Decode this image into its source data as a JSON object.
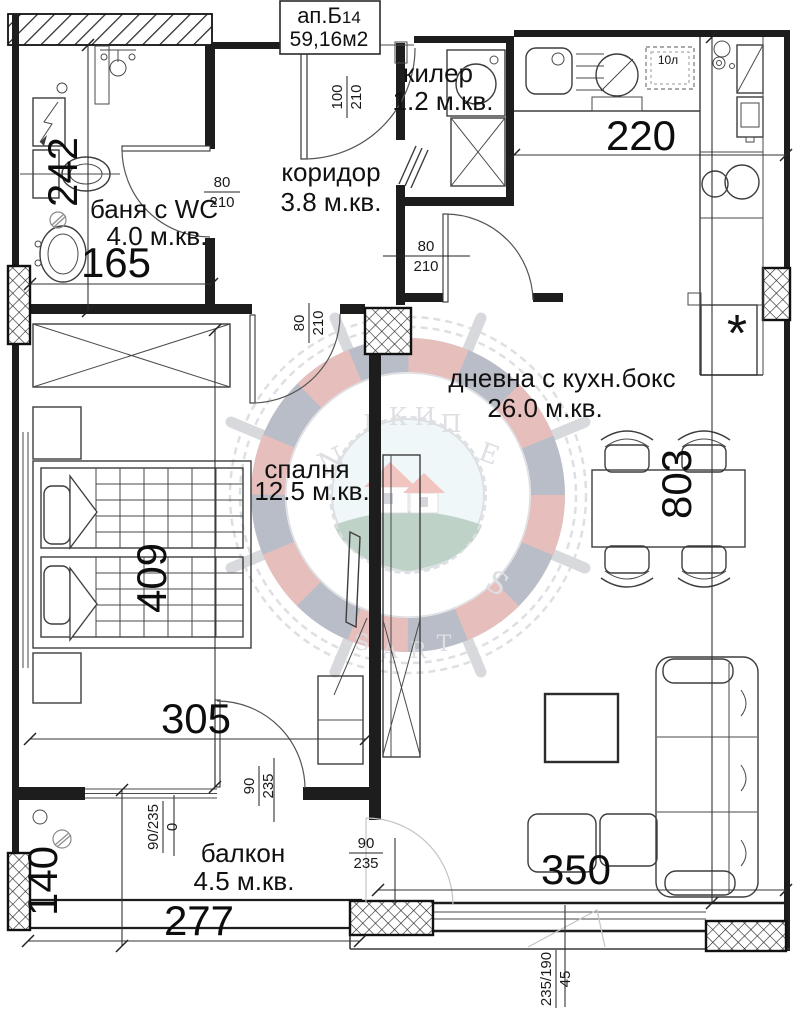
{
  "title": {
    "name": "ап.Б",
    "unit_number": "14",
    "total_area": "59,16м2"
  },
  "rooms": {
    "bathroom": {
      "name": "баня с WC",
      "area": "4.0 м.кв."
    },
    "corridor": {
      "name": "коридор",
      "area": "3.8 м.кв."
    },
    "closet": {
      "name": "килер",
      "area": "1.2 м.кв."
    },
    "living": {
      "name": "дневна с кухн.бокс",
      "area": "26.0 м.кв."
    },
    "bedroom": {
      "name": "спалня",
      "area": "12.5 м.кв."
    },
    "balcony": {
      "name": "балкон",
      "area": "4.5 м.кв."
    }
  },
  "dimensions": {
    "bathroom_depth": "242",
    "bathroom_width": "165",
    "kitchen_wall": "220",
    "living_depth": "803",
    "living_width": "350",
    "bedroom_depth": "409",
    "bedroom_width": "305",
    "balcony_depth": "140",
    "balcony_width": "277"
  },
  "openings": {
    "entry_door": {
      "w": "100",
      "h": "210"
    },
    "bathroom_door": {
      "w": "80",
      "h": "210"
    },
    "living_door": {
      "w": "80",
      "h": "210"
    },
    "bedroom_door": {
      "w": "80",
      "h": "210"
    },
    "bedroom_balcony_door": {
      "w": "90",
      "h": "235"
    },
    "balcony_window": {
      "size": "90/235",
      "sill": "0"
    },
    "living_balcony_door": {
      "w": "90",
      "h": "235"
    },
    "living_window": {
      "size": "235/190",
      "sill": "45"
    }
  },
  "labels": {
    "boiler": "10л",
    "fridge_symbol": "*"
  },
  "watermark": {
    "arc_top": [
      "Е",
      "К",
      "И",
      "П"
    ],
    "arc_bottom": [
      "S",
      "А",
      "R",
      "Т"
    ],
    "left": "N",
    "right": "Е",
    "bottom_right": "S",
    "colors": {
      "red": "#b43f3a",
      "navy": "#2f3a59",
      "roof": "#d8503f",
      "hill": "#3f7a5a",
      "sky": "#cfe7ef",
      "rope": "#9aa1ac"
    }
  }
}
